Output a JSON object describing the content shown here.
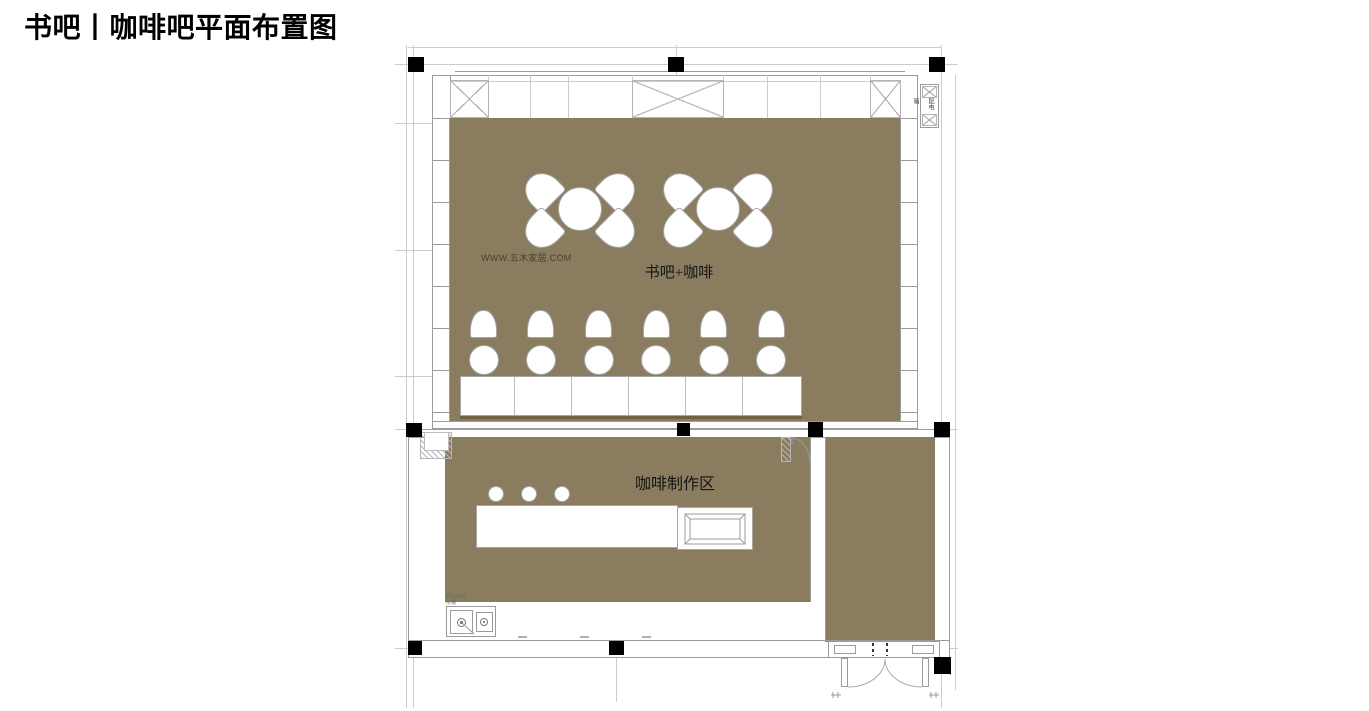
{
  "title": "书吧丨咖啡吧平面布置图",
  "watermark": "WWW.五木家居.COM",
  "rooms": {
    "book_bar": {
      "label": "书吧+咖啡",
      "round_tables": 2,
      "chairs_per_table": 4,
      "window_seat_sets": 6
    },
    "coffee_station": {
      "label": "咖啡制作区",
      "bar_stools": 3
    }
  },
  "annotations": {
    "shaft_label": "配电箱",
    "sink_dim": "750x450",
    "sink_name": "水槽"
  },
  "colors": {
    "floor": "#8a7c5f",
    "column": "#000000",
    "wall_line": "#9b9b9b",
    "grid_line": "#cccccc",
    "furniture_outline": "#a6a6a6"
  }
}
